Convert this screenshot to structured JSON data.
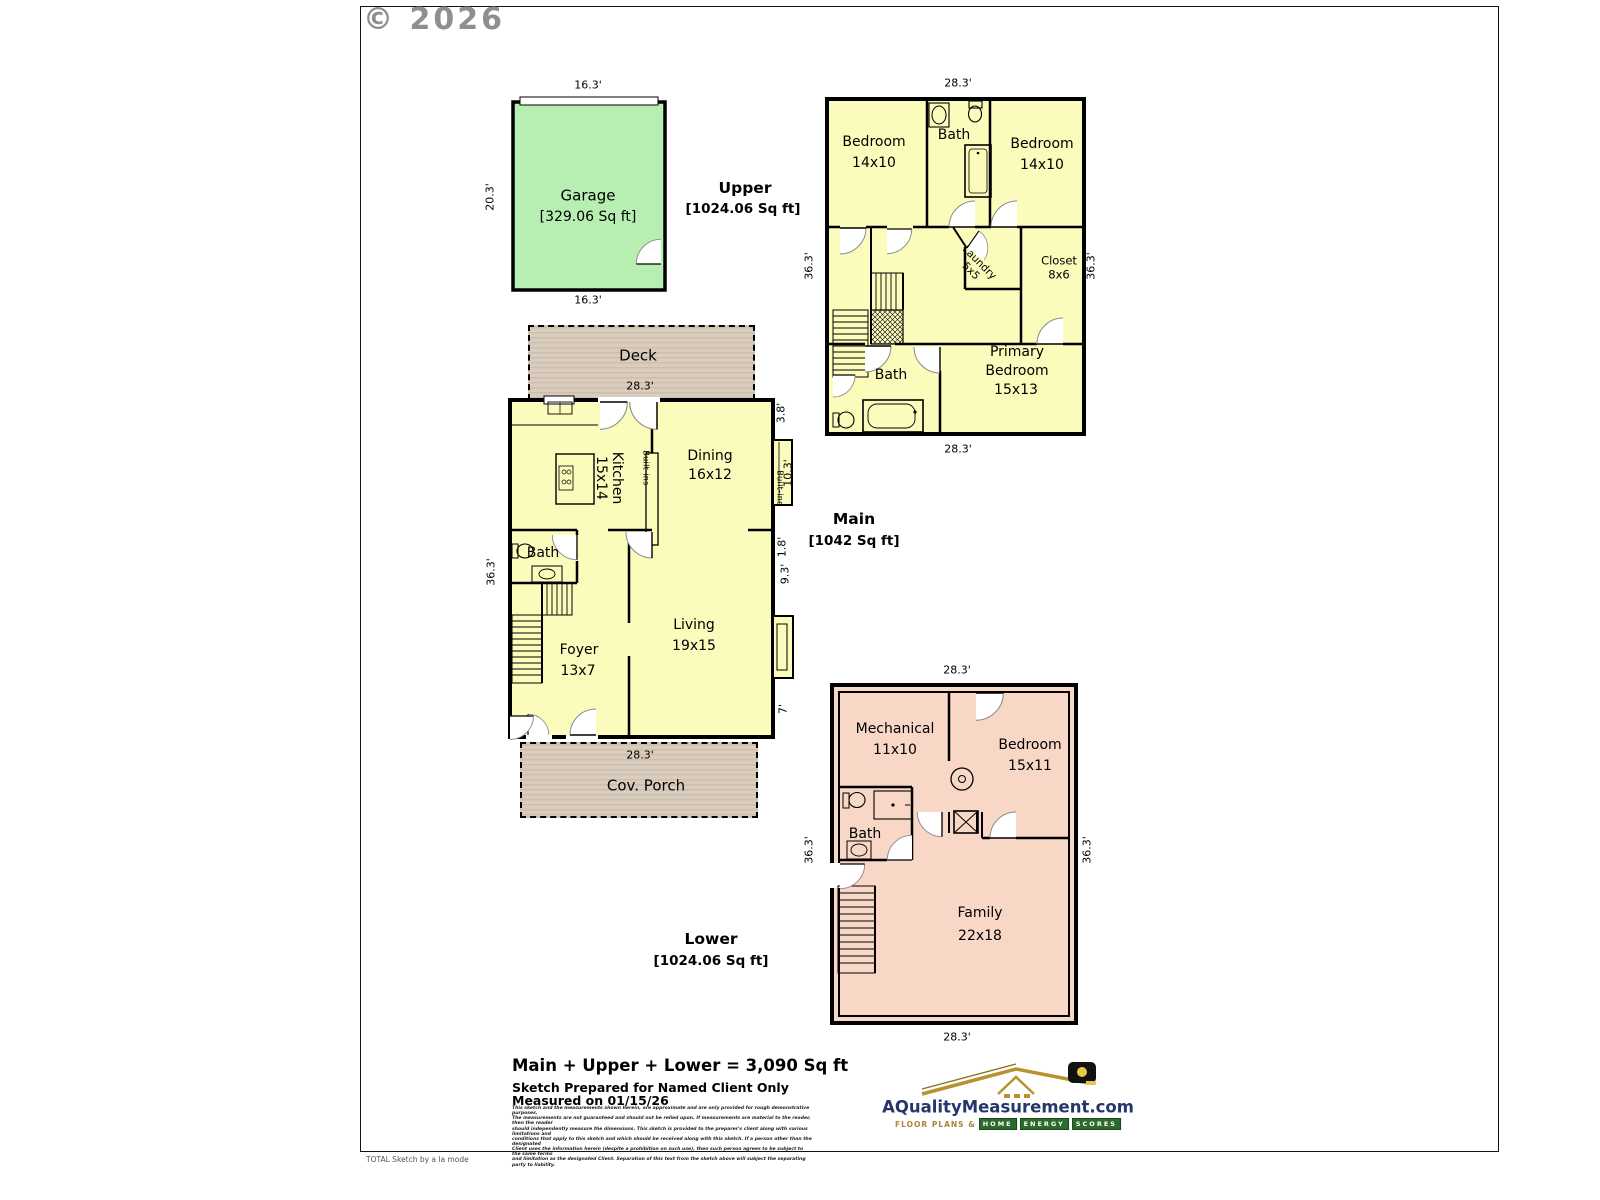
{
  "page": {
    "copyright": "© 2026",
    "credit": "TOTAL Sketch by a la mode"
  },
  "garage": {
    "name": "Garage",
    "sqft": "[329.06 Sq ft]",
    "dim_top": "16.3'",
    "dim_bottom": "16.3'",
    "dim_left": "20.3'"
  },
  "upper": {
    "title": "Upper",
    "sqft": "[1024.06 Sq ft]",
    "dim_top": "28.3'",
    "dim_bottom": "28.3'",
    "dim_left": "36.3'",
    "dim_right": "36.3'",
    "bedroom_left_name": "Bedroom",
    "bedroom_left_size": "14x10",
    "bath_name": "Bath",
    "bedroom_right_name": "Bedroom",
    "bedroom_right_size": "14x10",
    "laundry_name": "Laundry",
    "laundry_size": "5x5",
    "closet_name": "Closet",
    "closet_size": "8x6",
    "bath2_name": "Bath",
    "primary_l1": "Primary",
    "primary_l2": "Bedroom",
    "primary_size": "15x13"
  },
  "main": {
    "title": "Main",
    "sqft": "[1042 Sq ft]",
    "deck_name": "Deck",
    "porch_name": "Cov. Porch",
    "dim_top": "28.3'",
    "dim_bottom": "28.3'",
    "dim_left": "36.3'",
    "dim_r1": "3.8'",
    "dim_r2": "10.3'",
    "dim_r3": "1.8'",
    "dim_r4": "9.3'",
    "dim_r5": "7'",
    "kitchen_name": "Kitchen",
    "kitchen_size": "15x14",
    "dining_name": "Dining",
    "dining_size": "16x12",
    "builtins_a": "Built-ins",
    "builtins_b": "Built-ins",
    "bath_name": "Bath",
    "foyer_name": "Foyer",
    "foyer_size": "13x7",
    "living_name": "Living",
    "living_size": "19x15"
  },
  "lower": {
    "title": "Lower",
    "sqft": "[1024.06 Sq ft]",
    "dim_top": "28.3'",
    "dim_bottom": "28.3'",
    "dim_left": "36.3'",
    "dim_right": "36.3'",
    "mech_name": "Mechanical",
    "mech_size": "11x10",
    "bedroom_name": "Bedroom",
    "bedroom_size": "15x11",
    "bath_name": "Bath",
    "family_name": "Family",
    "family_size": "22x18"
  },
  "summary": {
    "total": "Main + Upper + Lower = 3,090 Sq ft",
    "prepared_for": "Sketch Prepared for Named Client Only",
    "measured_on": "Measured on 01/15/26",
    "disclaimer": [
      "This sketch and the measurements shown herein, are approximate and are only provided for rough demonstrative purposes.",
      "The measurements are not guaranteed and should not be relied upon.  If measurements are material to the reader, then the reader",
      "should independently measure the dimensions.  This sketch is provided to the preparer's client along with various limitations and",
      "conditions that apply to this sketch and which should be received along with this sketch.  If a person other than the designated",
      "Client uses the information herein (despite a prohibition on such use), then such person agrees to be subject to the same terms",
      "and limitation as the designated Client.  Separation of this text from the sketch above will subject the separating party to liability."
    ]
  },
  "logo": {
    "domain": "AQualityMeasurement.com",
    "tagline_prefix": "Floor Plans &",
    "tagline_words": [
      "Home",
      "Energy",
      "Scores"
    ]
  },
  "colors": {
    "floor_yellow": "#fbfbbc",
    "garage_green": "#b7efb2",
    "lower_pink": "#f8d7c6",
    "deck_tan": "#d6c8b7",
    "logo_navy": "#26356b",
    "logo_gold": "#b8922e",
    "logo_green": "#2d6a2d"
  }
}
